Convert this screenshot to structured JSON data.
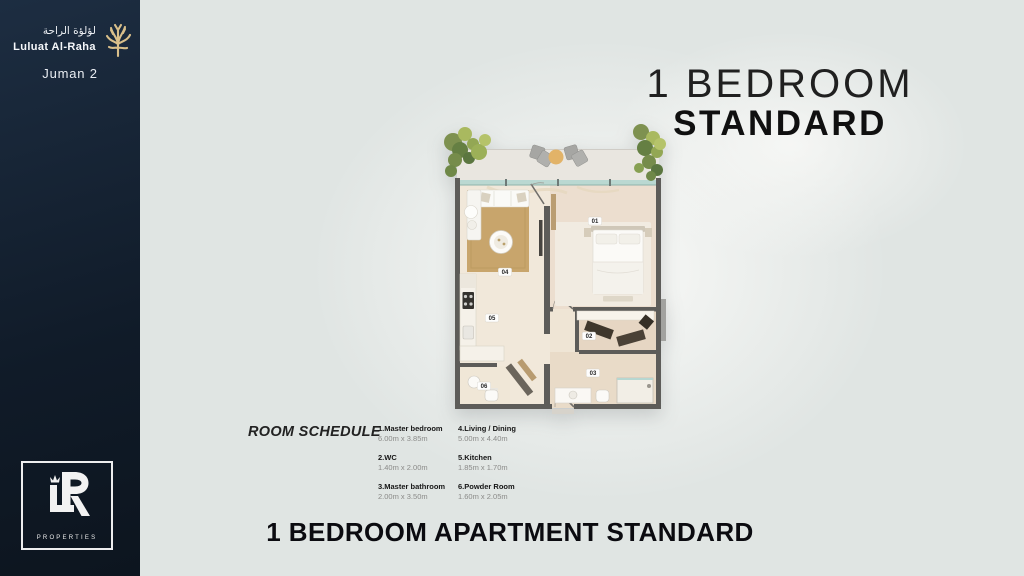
{
  "window": {
    "width": 1024,
    "height": 576
  },
  "sidebar": {
    "arabic_name": "لؤلؤة الراحة",
    "brand_name": "Luluat Al-Raha",
    "project_name": "Juman 2",
    "logo": {
      "monogram_letters": "LR",
      "caption": "PROPERTIES"
    }
  },
  "title": {
    "line1": "1 BEDROOM",
    "line2": "STANDARD"
  },
  "floorplan": {
    "labels": [
      "01",
      "02",
      "03",
      "04",
      "05",
      "06"
    ]
  },
  "room_schedule": {
    "title": "ROOM SCHEDULE",
    "columns": [
      [
        {
          "name": "1.Master bedroom",
          "dims": "6.00m x 3.85m"
        },
        {
          "name": "2.WC",
          "dims": "1.40m x 2.00m"
        },
        {
          "name": "3.Master bathroom",
          "dims": "2.00m x 3.50m"
        }
      ],
      [
        {
          "name": "4.Living / Dining",
          "dims": "5.00m x 4.40m"
        },
        {
          "name": "5.Kitchen",
          "dims": "1.85m x 1.70m"
        },
        {
          "name": "6.Powder Room",
          "dims": "1.60m x 2.05m"
        }
      ]
    ]
  },
  "footer": {
    "caption": "1 BEDROOM APARTMENT STANDARD"
  },
  "colors": {
    "sidebar_bg": "#13202f",
    "canvas_bg": "#e0e5e3",
    "accent_gold": "#d9bf8a",
    "wall_gray": "#5d5c59",
    "floor_cream": "#f1e8da",
    "floor_blush": "#ecdecf",
    "rug_tan": "#c8a56c",
    "glass_teal": "#b7d7d1",
    "text_dark": "#141414"
  }
}
